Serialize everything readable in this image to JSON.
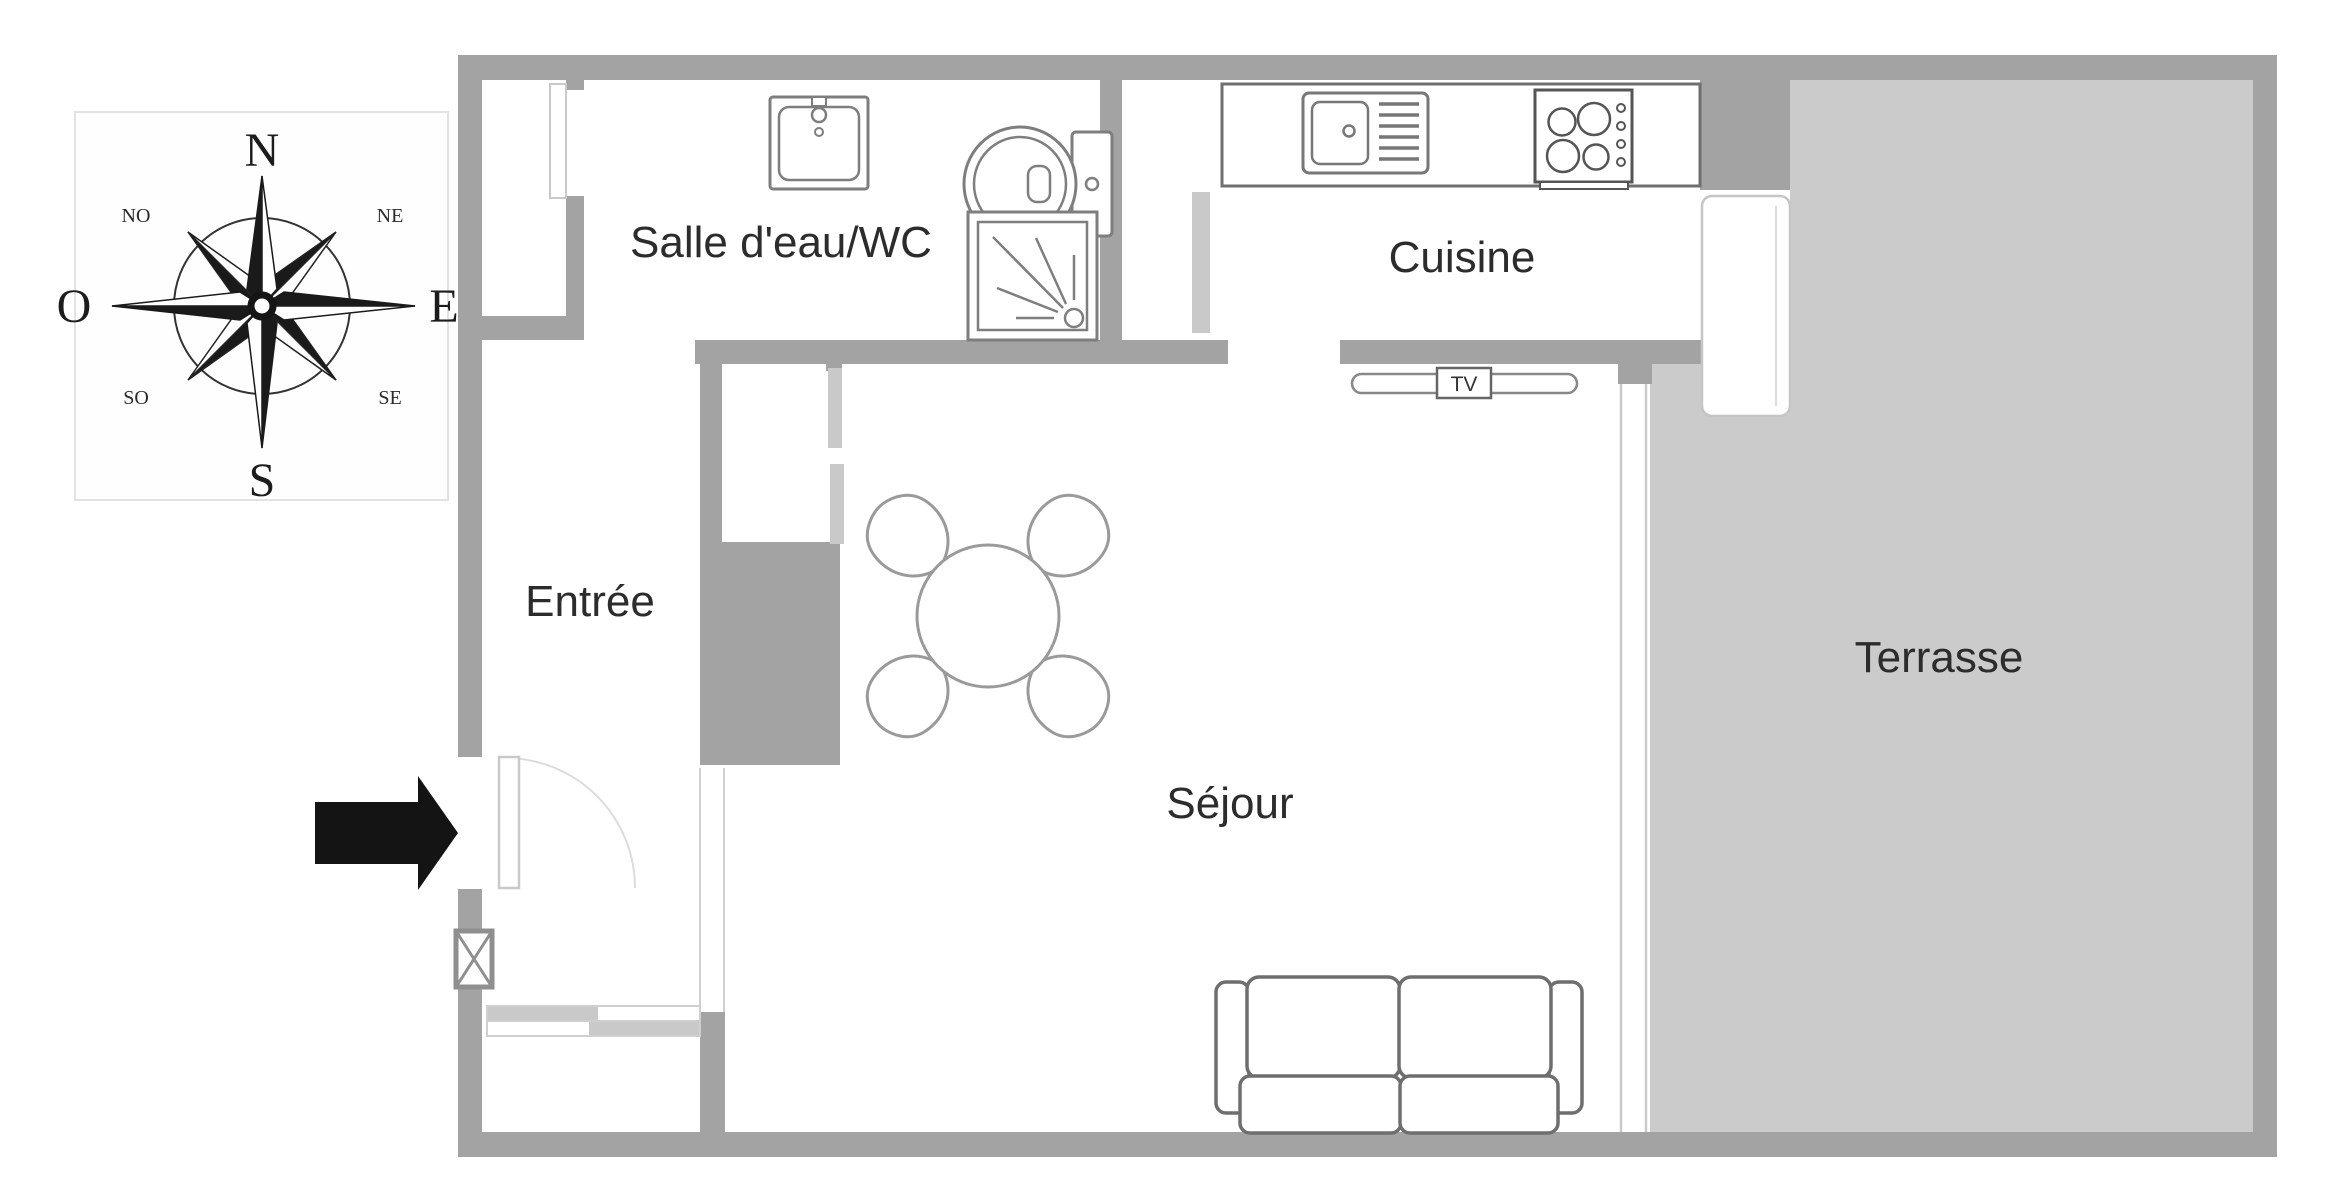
{
  "plan": {
    "rooms": {
      "bathroom": {
        "label": "Salle d'eau/WC"
      },
      "kitchen": {
        "label": "Cuisine"
      },
      "entry": {
        "label": "Entrée"
      },
      "living": {
        "label": "Séjour"
      },
      "terrace": {
        "label": "Terrasse"
      }
    },
    "tv_label": "TV",
    "compass": {
      "n": "N",
      "ne": "NE",
      "e": "E",
      "se": "SE",
      "s": "S",
      "so": "SO",
      "o": "O",
      "no": "NO"
    },
    "colors": {
      "wall": "#a3a3a3",
      "terrace_fill": "#cbcbcb",
      "light_door_gray": "#c9c9c9",
      "fixture_stroke": "#7e7e7e",
      "furniture_stroke": "#9a9a9a",
      "sofa_stroke": "#6e6e6e",
      "text": "#2c2c2c",
      "arrow": "#141414"
    },
    "icons": [
      "compass-rose-icon",
      "bathroom-sink-icon",
      "toilet-icon",
      "shower-icon",
      "kitchen-sink-icon",
      "stove-icon",
      "tv-stand-icon",
      "dining-table-icon",
      "chair-icon",
      "sofa-icon",
      "entry-door-icon",
      "sliding-wardrobe-icon",
      "electrical-box-icon",
      "entry-arrow-icon",
      "terrace-door-icon",
      "bay-window-icon"
    ]
  }
}
